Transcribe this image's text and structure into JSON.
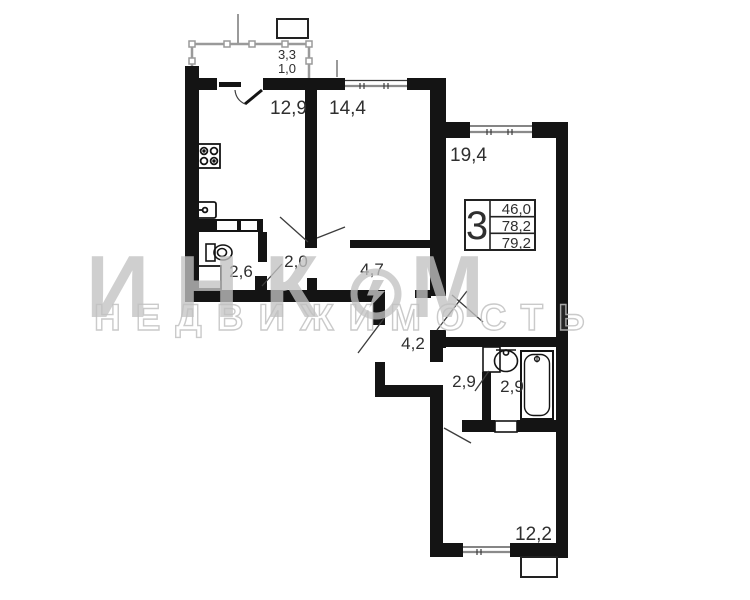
{
  "plan": {
    "balcony": {
      "area_upper": "3,3",
      "area_lower": "1,0"
    },
    "rooms": {
      "kitchen": "12,9",
      "bedroom1": "14,4",
      "living": "19,4",
      "wc": "2,6",
      "hall": "2,0",
      "corridor": "4,7",
      "hallway": "4,2",
      "lobby": "2,9",
      "bathroom": "2,9",
      "bedroom2": "12,2"
    },
    "legend": {
      "rooms_count": "3",
      "living_area": "46,0",
      "floor_area": "78,2",
      "total_area": "79,2"
    }
  },
  "watermark": {
    "brand": "ИНКОМ",
    "brand_left": "ИНК",
    "brand_right": "М",
    "subtitle": "НЕДВИЖИМОСТЬ"
  },
  "colors": {
    "wall": "#141414",
    "thin_line": "#3c3c3c",
    "watermark": "#c1c1c1",
    "background": "#ffffff"
  }
}
